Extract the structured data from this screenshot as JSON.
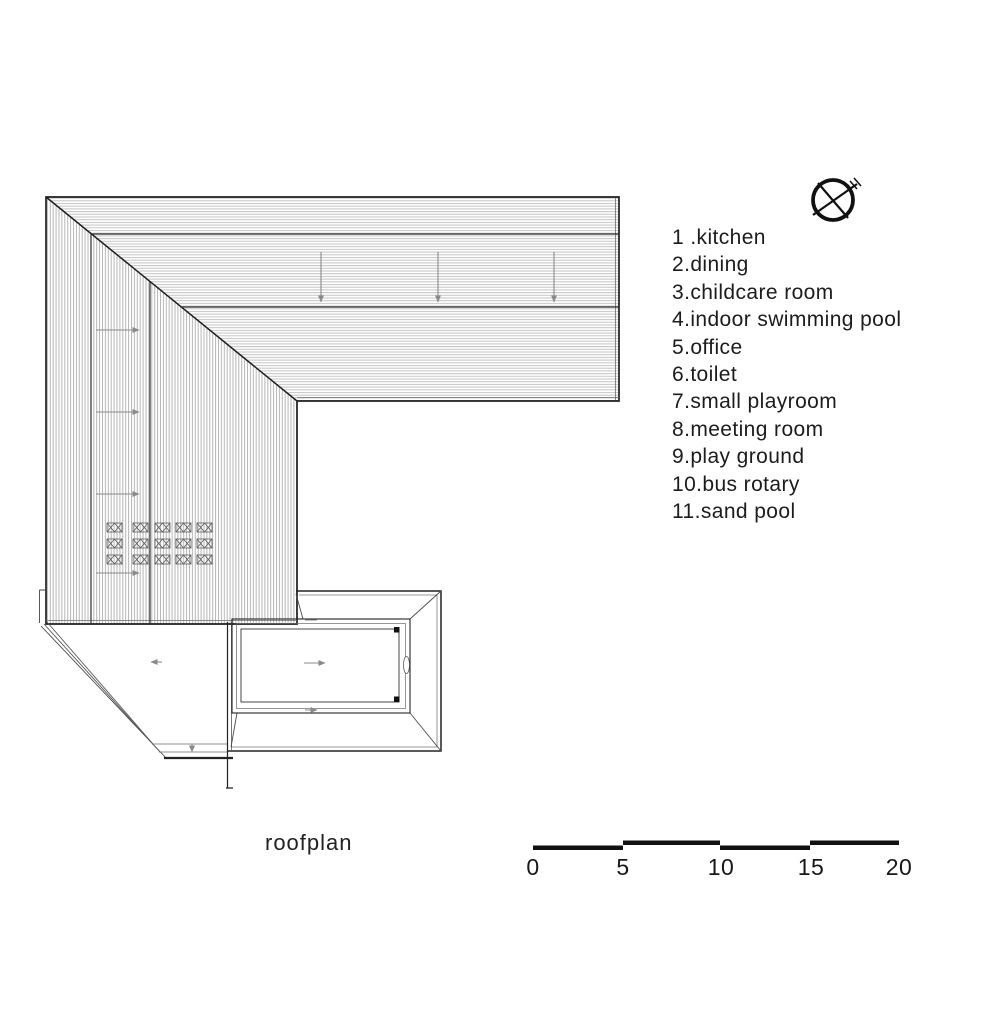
{
  "legend": {
    "items": [
      "1 .kitchen",
      "2.dining",
      "3.childcare room",
      "4.indoor swimming pool",
      "5.office",
      "6.toilet",
      "7.small playroom",
      "8.meeting room",
      "9.play ground",
      "10.bus rotary",
      "11.sand pool"
    ]
  },
  "caption": "roofplan",
  "scale_bar": {
    "labels": [
      "0",
      "5",
      "10",
      "15",
      "20"
    ]
  },
  "icons": {
    "north": "compass-north-arrow"
  },
  "colors": {
    "line": "#1f1f1f",
    "hatch_horizontal": "#c3c3c3",
    "hatch_vertical": "#b5b5b5",
    "arrow": "#8a8a8a",
    "text": "#1c1c1c"
  }
}
